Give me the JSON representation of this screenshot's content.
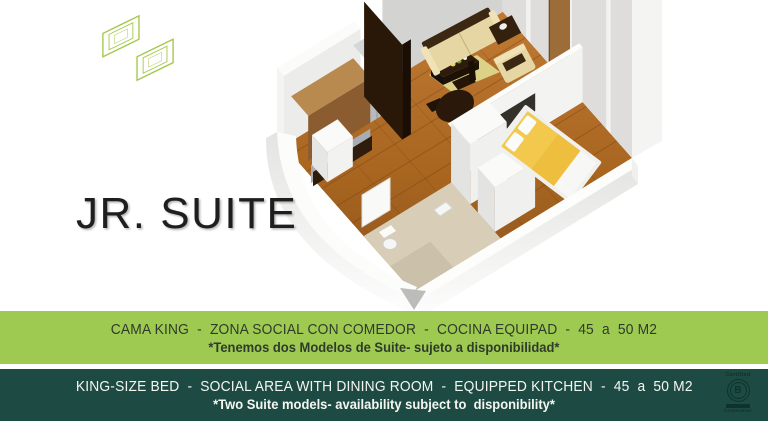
{
  "slide": {
    "title": "JR. SUITE",
    "background": "#ffffff"
  },
  "logo": {
    "description": "interlocking-s-outline-logo",
    "color": "#a3c84b"
  },
  "floor_plan": {
    "colors": {
      "wood_floor": "#b06f2c",
      "bathroom_floor": "#d8cdb6",
      "bed_cover": "#f2c94c",
      "sofa": "#e6d6a4",
      "rug": "#dbd288",
      "walls": "#f2f2f0",
      "dark_wood": "#2b1a0b"
    }
  },
  "bands": {
    "spanish": {
      "bg": "#9fca51",
      "text_color": "#2e3b2c",
      "line1": "CAMA KING  -  ZONA SOCIAL CON COMEDOR  -  COCINA EQUIPAD  -  45  a  50 M2",
      "line2": "*Tenemos dos Modelos de Suite- sujeto a disponibilidad*"
    },
    "english": {
      "bg": "#1d4b43",
      "text_color": "#f4f6f0",
      "line1": "KING-SIZE BED  -  SOCIAL AREA WITH DINING ROOM  -  EQUIPPED KITCHEN  -  45  a  50 M2",
      "line2": "*Two Suite models- availability subject to  disponibility*"
    }
  },
  "certification": {
    "top_label": "Certified",
    "letter": "B",
    "bottom_label": "Corporation"
  }
}
